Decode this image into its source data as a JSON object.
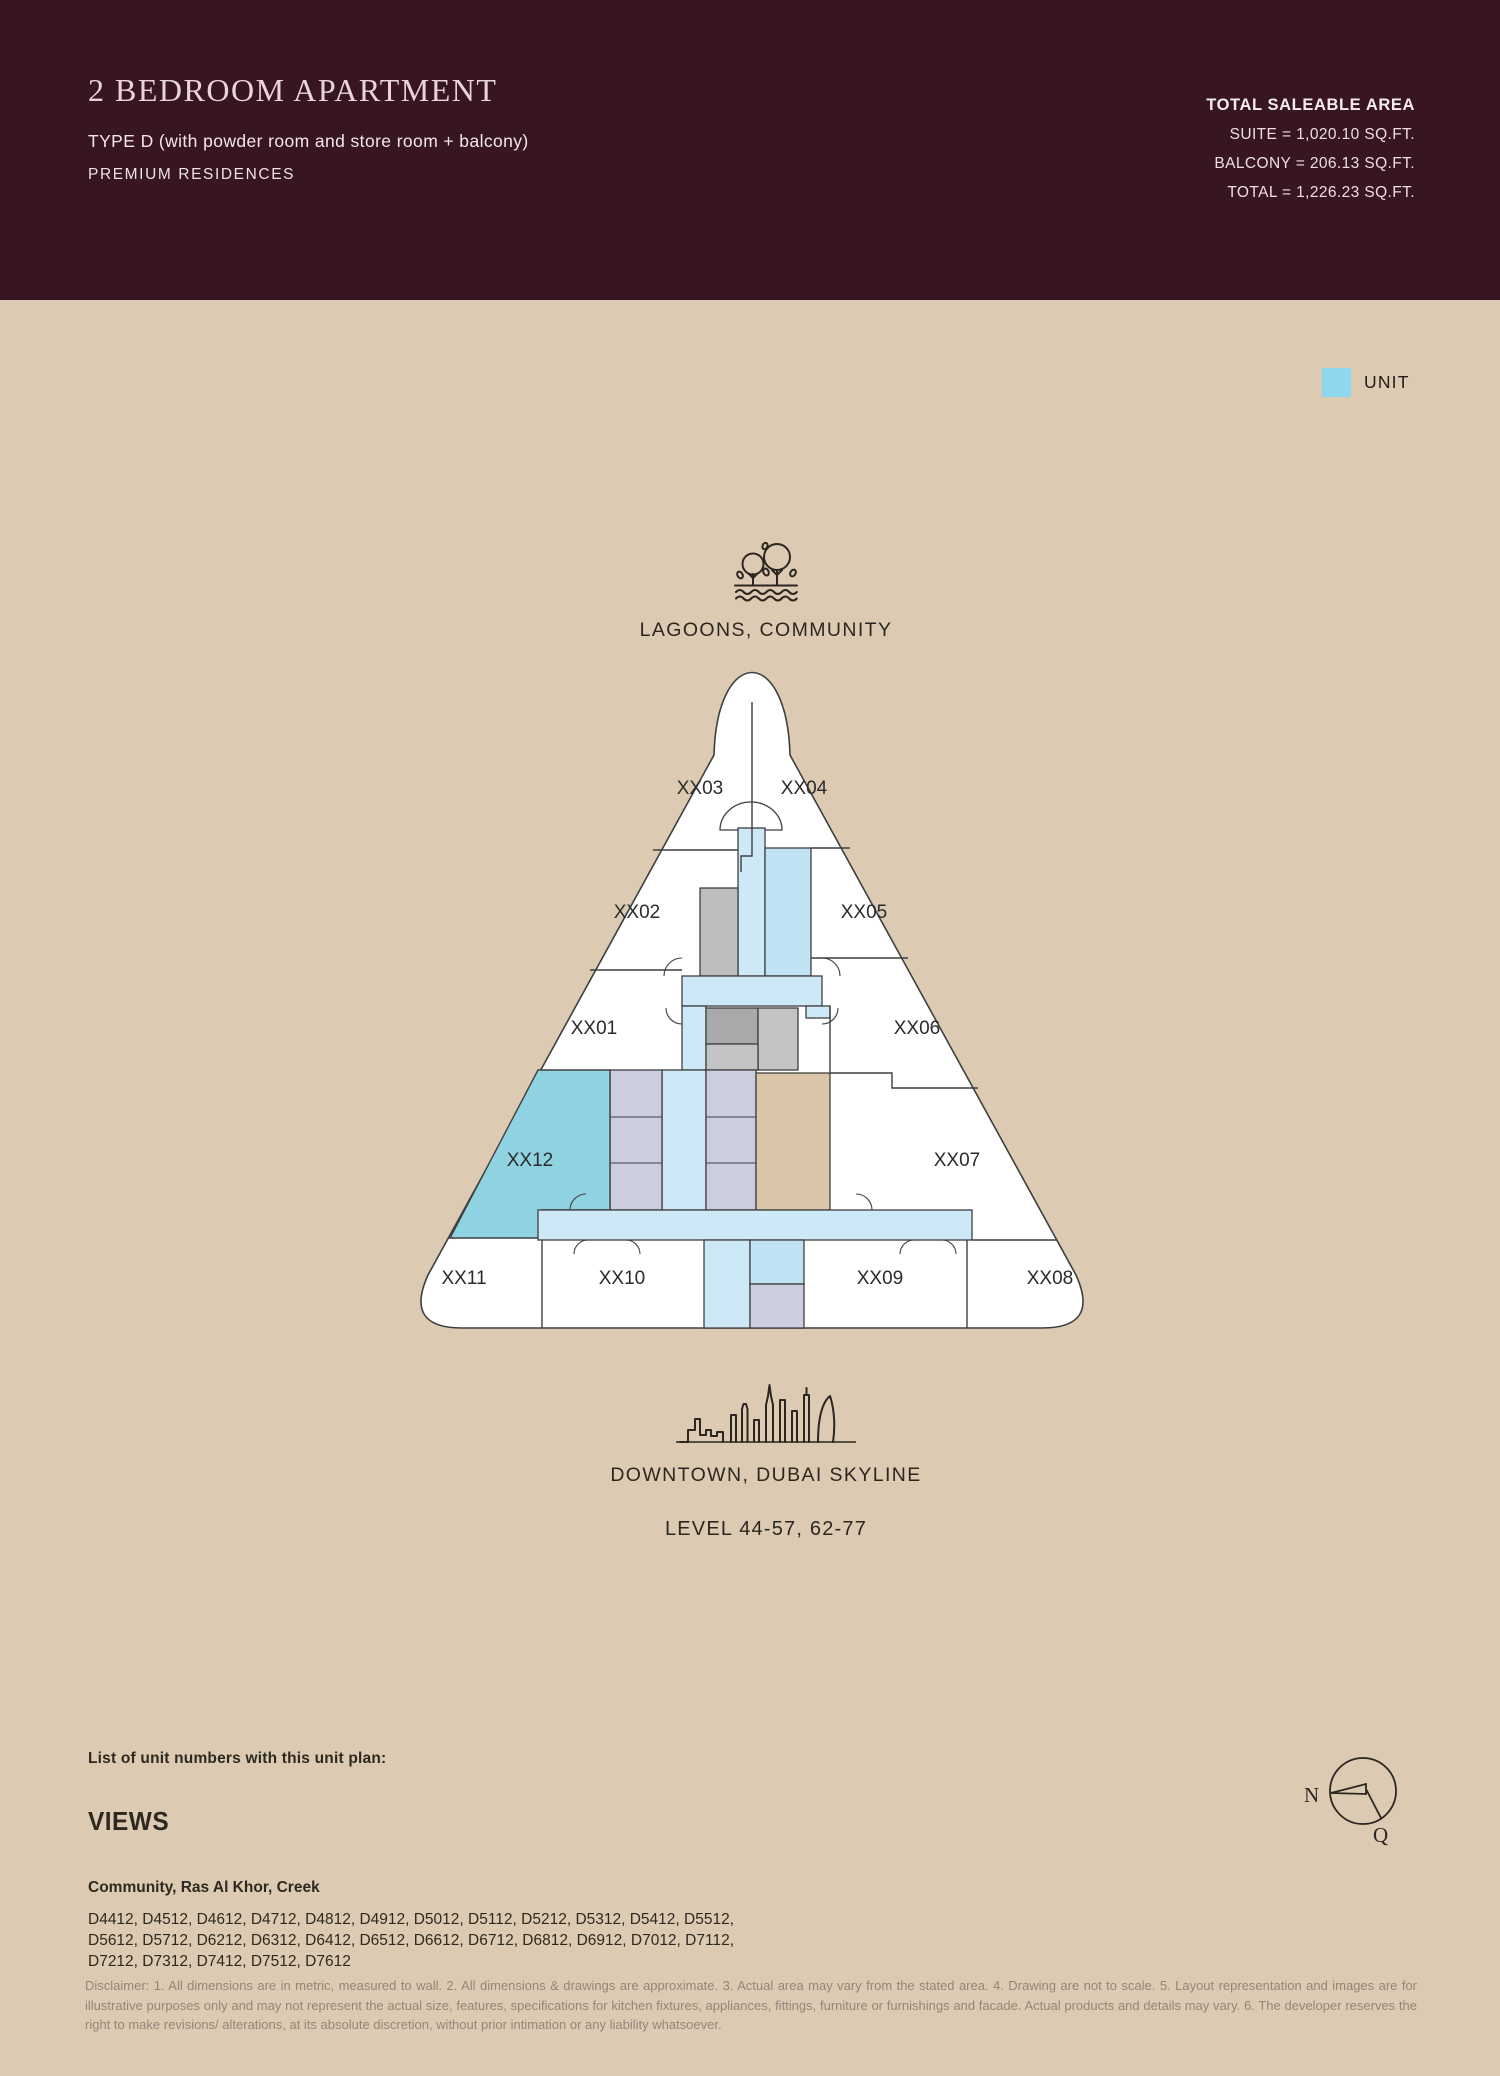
{
  "header": {
    "title": "2 BEDROOM APARTMENT",
    "subtitle": "TYPE D (with powder room and store room + balcony)",
    "tagline": "PREMIUM RESIDENCES",
    "background_color": "#371522",
    "area": {
      "heading": "TOTAL SALEABLE AREA",
      "suite": "SUITE = 1,020.10 SQ.FT.",
      "balcony": "BALCONY = 206.13 SQ.FT.",
      "total": "TOTAL = 1,226.23 SQ.FT."
    }
  },
  "legend": {
    "unit_label": "UNIT",
    "unit_color": "#8dd8ef"
  },
  "plan": {
    "top_view_label": "LAGOONS, COMMUNITY",
    "bottom_view_label": "DOWNTOWN, DUBAI SKYLINE",
    "level_label": "LEVEL 44-57, 62-77",
    "highlighted_unit": "XX12",
    "highlight_color": "#8fd2e2",
    "corridor_color": "#cde8f7",
    "units": {
      "u01": "XX01",
      "u02": "XX02",
      "u03": "XX03",
      "u04": "XX04",
      "u05": "XX05",
      "u06": "XX06",
      "u07": "XX07",
      "u08": "XX08",
      "u09": "XX09",
      "u10": "XX10",
      "u11": "XX11",
      "u12": "XX12"
    }
  },
  "compass": {
    "north_label": "N",
    "qibla_label": "Q"
  },
  "footer": {
    "list_heading": "List of unit numbers with this unit plan:",
    "views_heading": "VIEWS",
    "views_value": "Community, Ras Al Khor, Creek",
    "unit_numbers": "D4412, D4512, D4612, D4712, D4812, D4912, D5012, D5112, D5212, D5312, D5412, D5512,\nD5612, D5712, D6212, D6312, D6412, D6512, D6612, D6712, D6812, D6912, D7012, D7112,\nD7212, D7312, D7412, D7512, D7612",
    "disclaimer": "Disclaimer: 1. All dimensions are in metric, measured to wall. 2. All dimensions & drawings are approximate. 3. Actual area may vary from the stated area. 4. Drawing are not to scale. 5. Layout representation and images are for illustrative purposes only and may not represent the actual size, features, specifications for kitchen fixtures, appliances, fittings, furniture or furnishings and facade. Actual products and details may vary. 6. The developer reserves the right to make revisions/ alterations, at its absolute discretion, without prior intimation or any liability whatsoever."
  }
}
